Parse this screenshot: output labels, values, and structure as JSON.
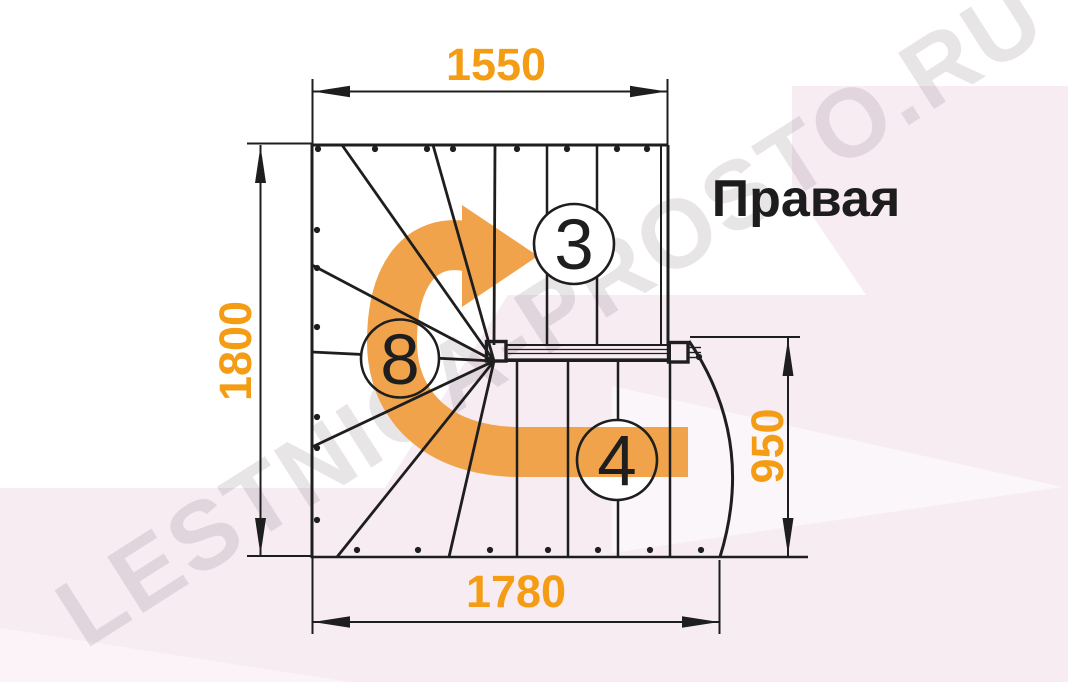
{
  "diagram": {
    "title": "Правая",
    "watermark": "LESTNICA-PROSTO.RU",
    "dimensions": {
      "top_width_mm": "1550",
      "left_height_mm": "1800",
      "bottom_width_mm": "1780",
      "right_height_mm": "950"
    },
    "step_labels": {
      "top_flight": "3",
      "winder": "8",
      "bottom_flight": "4"
    },
    "colors": {
      "dimension_text": "#F59C15",
      "direction_arrow": "#F0A34A",
      "linework": "#1E1E1E",
      "background_pink": "#F7ECF2",
      "watermark_gray": "#8F7F8C"
    }
  }
}
